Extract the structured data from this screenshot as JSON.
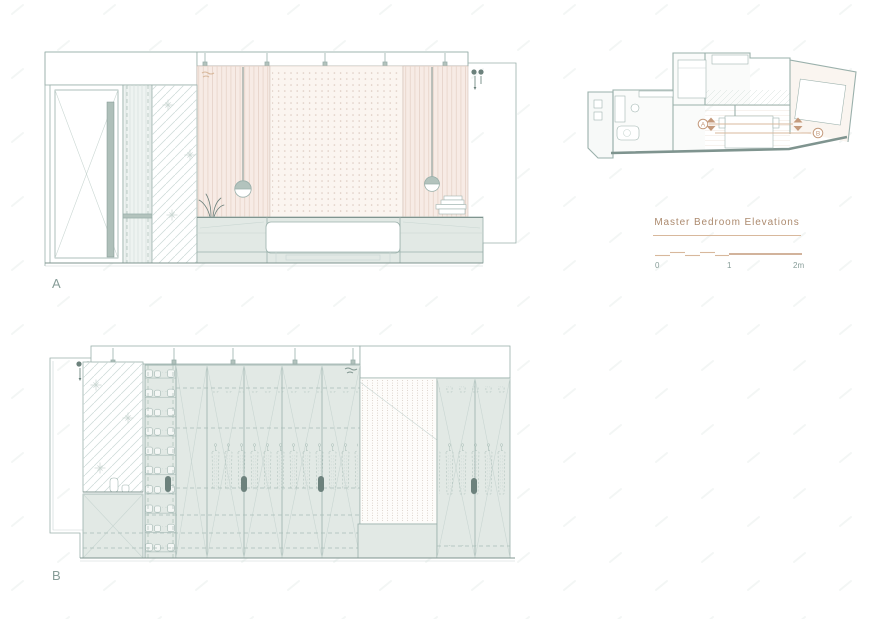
{
  "colors": {
    "line": "#9ab0ab",
    "line_mid": "#a9bdb7",
    "line_dark": "#7f948f",
    "line_faint": "#c9d6d2",
    "sage_fill": "#e2e9e5",
    "sage_mid": "#b3c3bd",
    "sage_dark": "#6c817c",
    "handle": "#aebfb9",
    "pink_fill": "#f7ebe5",
    "pink_stripe": "#e8d5cb",
    "cream_fill": "#fbf5f0",
    "dot": "#dbc9bf",
    "tan": "#c49a7c",
    "tan_light": "#d8b89c",
    "label_text": "#879d98",
    "title_text": "#ac8a6e",
    "watermark": "#e9efec"
  },
  "drawings": {
    "elevation_a": {
      "label": "A"
    },
    "elevation_b": {
      "label": "B"
    }
  },
  "plan": {
    "section_marker_a": "A",
    "section_marker_b": "B"
  },
  "title_block": {
    "title": "Master Bedroom Elevations",
    "scale_labels": {
      "zero": "0",
      "one": "1",
      "two": "2m"
    }
  }
}
